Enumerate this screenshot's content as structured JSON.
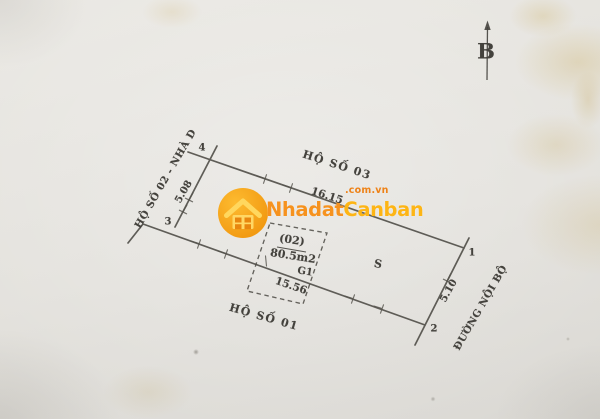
{
  "compass": {
    "label": "B"
  },
  "watermark": {
    "brand_first": "Nhadat",
    "brand_second": "Canban",
    "tld": ".com.vn",
    "circle_color": "#f6a21c",
    "brand_color_first": "#f6921e",
    "brand_color_second": "#fdb515"
  },
  "neighbors": {
    "north": "HỘ SỐ 03",
    "west": "HỘ SỐ 02 - NHÀ D",
    "south": "HỘ SỐ 01",
    "east_road": "ĐƯỜNG NỘI BỘ"
  },
  "dimensions": {
    "north": "16.15",
    "west": "5.08",
    "south": "15.56",
    "east": "5.10"
  },
  "parcel": {
    "id": "(02)",
    "area": "80.5m2",
    "gate": "G1",
    "section": "S"
  },
  "corners": {
    "c1": "1",
    "c2": "2",
    "c3": "3",
    "c4": "4"
  },
  "ink_color": "#4c4a44"
}
